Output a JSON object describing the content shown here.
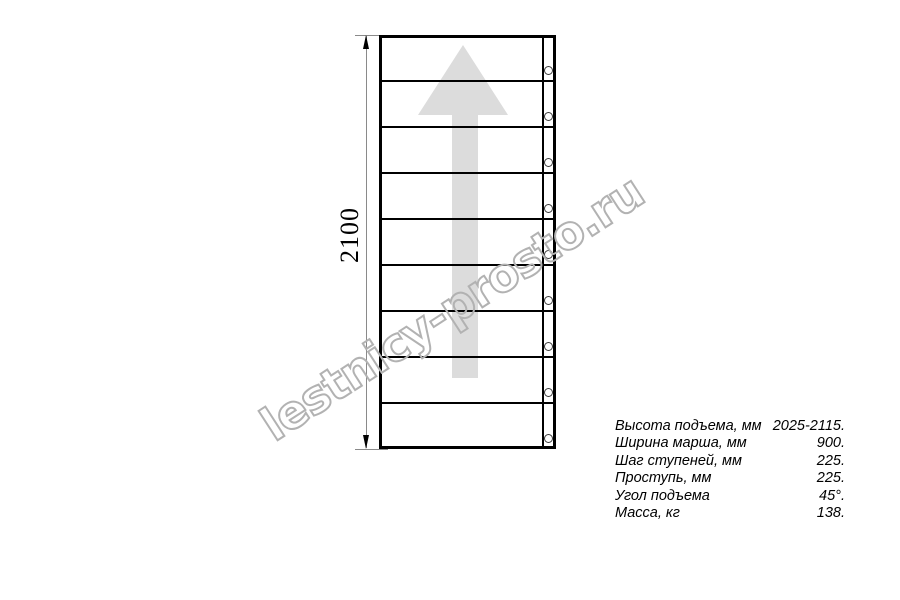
{
  "drawing": {
    "dimension_label": "2100",
    "steps_count": 9,
    "arrow_direction": "up",
    "colors": {
      "line": "#000000",
      "dimension": "#8a8a8a",
      "arrow_fill": "#dcdcdc",
      "watermark_outline": "#b2b2b2"
    }
  },
  "watermark": {
    "text": "lestnicy-prosto.ru"
  },
  "specs": {
    "rows": [
      {
        "label": "Высота подъема, мм",
        "value": "2025-2115."
      },
      {
        "label": "Ширина марша, мм",
        "value": "900."
      },
      {
        "label": "Шаг ступеней, мм",
        "value": "225."
      },
      {
        "label": "Проступь, мм",
        "value": "225."
      },
      {
        "label": "Угол подъема",
        "value": "45°."
      },
      {
        "label": "Масса, кг",
        "value": "138."
      }
    ]
  }
}
